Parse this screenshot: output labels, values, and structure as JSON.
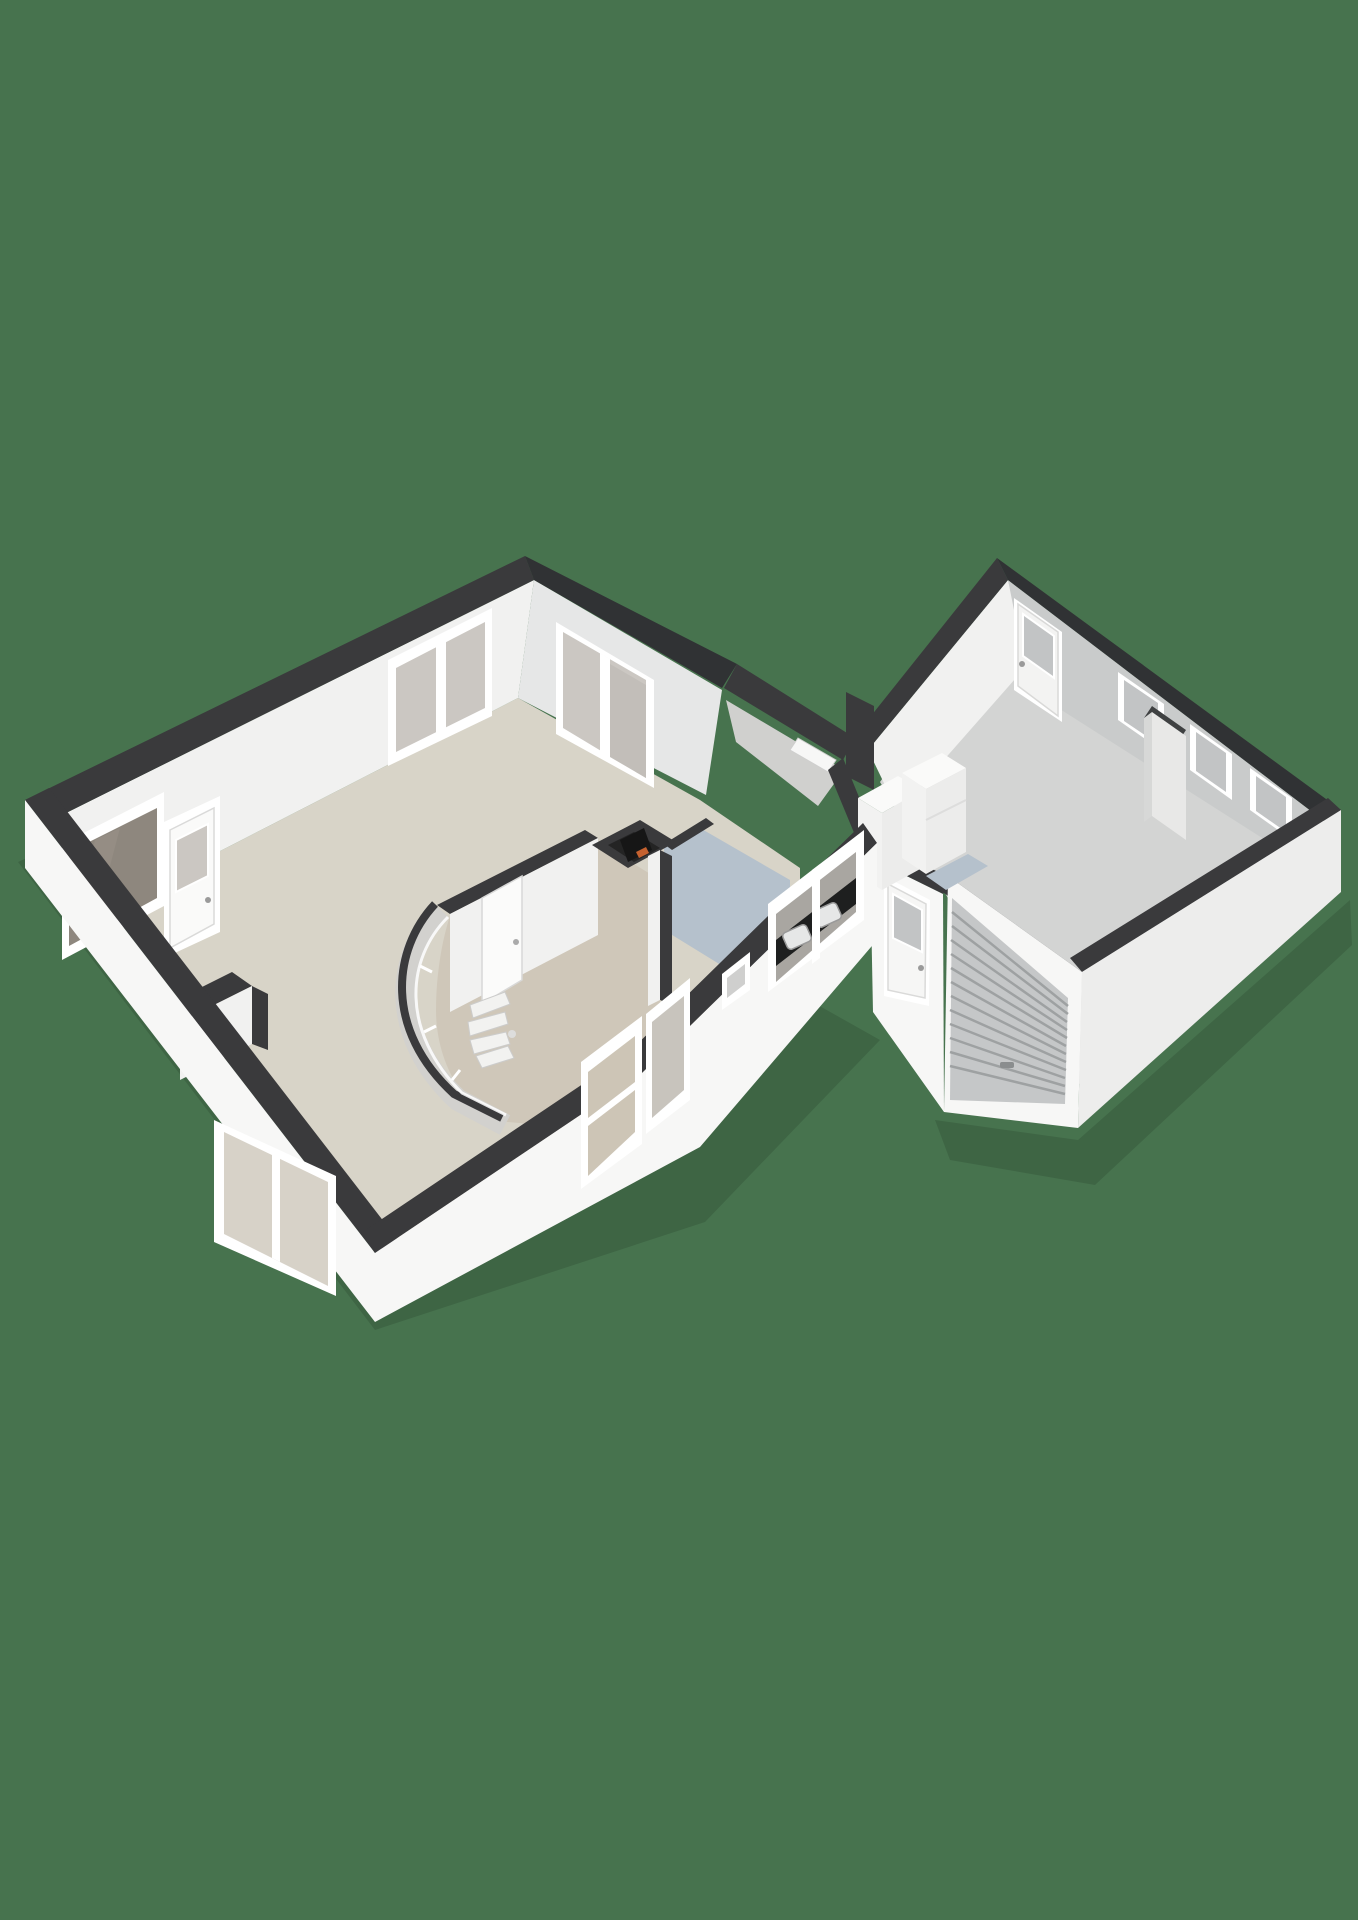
{
  "scene": {
    "type": "3d-floorplan-render",
    "view": "isometric-corner-view",
    "background": "plain-green",
    "buildings": [
      {
        "name": "main-house",
        "rooms": [
          "living-room",
          "hall",
          "bathroom",
          "boiler-closet",
          "kitchen"
        ],
        "features": [
          "front-window-upper",
          "front-door-with-glass",
          "dark-front-window",
          "sliding-patio-door",
          "curved-glass-wall",
          "spiral-staircase",
          "hall-interior-door",
          "boiler-unit",
          "kitchen-counter-with-two-sinks",
          "kitchen-window",
          "vent-grille",
          "hall-glass-door",
          "hall-window",
          "south-window",
          "storage-nook"
        ]
      },
      {
        "name": "garage-extension",
        "rooms": [
          "connecting-corridor",
          "utility-area",
          "garage"
        ],
        "features": [
          "corridor-threshold",
          "appliance-cabinets",
          "utility-floor-patch",
          "back-door-with-glass",
          "garage-entry-door-with-glass",
          "garage-window-1",
          "chimney-pillar",
          "garage-window-2",
          "garage-window-3",
          "roller-garage-door",
          "floor-threshold-marks"
        ]
      }
    ]
  },
  "colors": {
    "bg": "#47734E",
    "band": "#3A3A3C",
    "band2": "#303234",
    "extBright": "#F7F7F6",
    "extMid": "#EDEDEC",
    "innBright": "#F1F1F0",
    "innShade": "#C9CBCB",
    "innShade2": "#E6E7E7",
    "floorLiving": "#D8D4C8",
    "floorHall": "#CFC7B9",
    "floorBlue": "#B5C1CC",
    "floorGarage": "#D3D4D3",
    "glass": "#CBC7C2",
    "glassCool": "#C2C4C5",
    "glassDark": "#8E877E",
    "frame": "#FFFFFF",
    "counter": "#1E1F1F",
    "boiler": "#161616",
    "accentOrange": "#C4612F",
    "roller": "#C5C7C8",
    "rollerLine": "#9EA1A2",
    "shadow": "rgba(0,0,0,0.12)"
  }
}
